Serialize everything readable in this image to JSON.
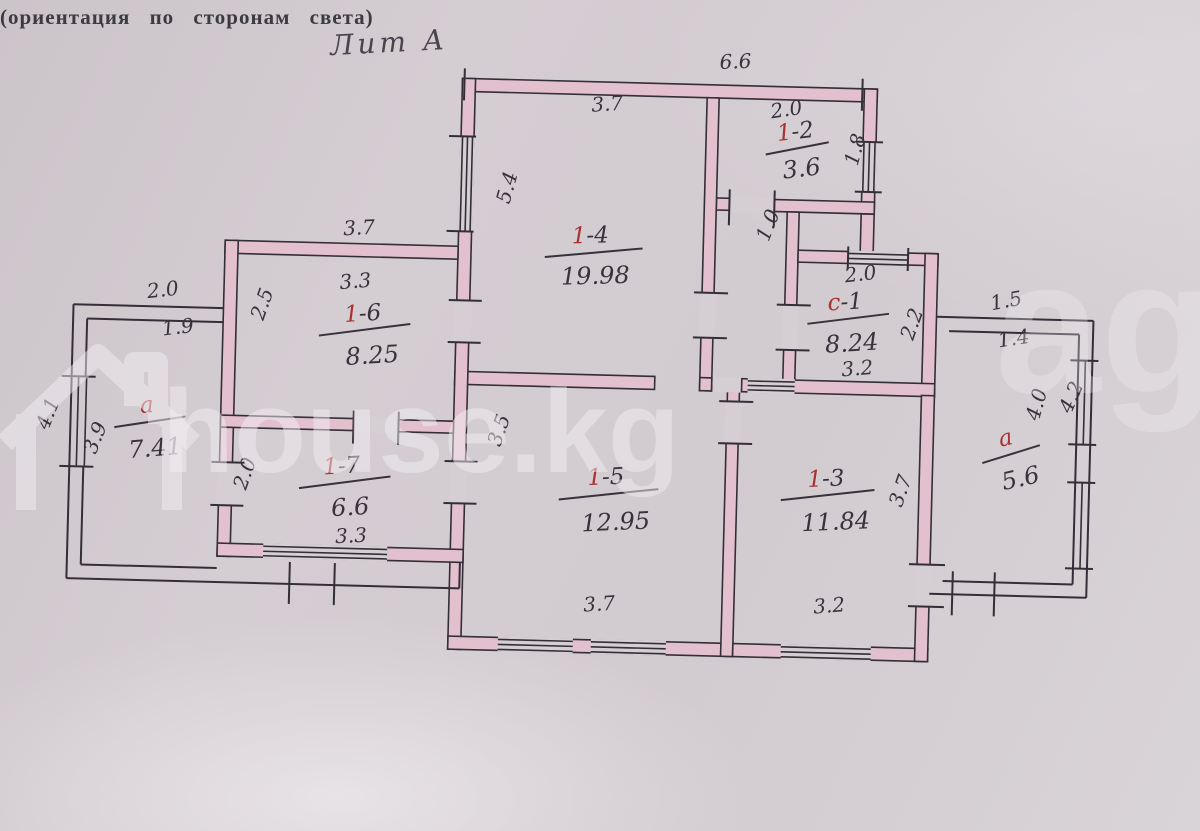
{
  "header": {
    "orientation_note": "(ориентация по сторонам света)",
    "liter_label": "Лит А"
  },
  "watermark": {
    "brand": "house.kg",
    "partial": "agi",
    "icon": "house-icon"
  },
  "rooms": [
    {
      "id_red": "1",
      "id_rest": "-4",
      "area": "19.98"
    },
    {
      "id_red": "1",
      "id_rest": "-2",
      "area": "3.6"
    },
    {
      "id_red": "с",
      "id_rest": "-1",
      "area": "8.24"
    },
    {
      "id_red": "1",
      "id_rest": "-6",
      "area": "8.25"
    },
    {
      "id_red": "а",
      "id_rest": "",
      "area": "7.41"
    },
    {
      "id_red": "1",
      "id_rest": "-7",
      "area": "6.6"
    },
    {
      "id_red": "1",
      "id_rest": "-5",
      "area": "12.95"
    },
    {
      "id_red": "1",
      "id_rest": "-3",
      "area": "11.84"
    },
    {
      "id_red": "а",
      "id_rest": "",
      "area": "5.6"
    }
  ],
  "dims": {
    "top_width": "6.6",
    "r14_top": "3.7",
    "r14_left": "5.4",
    "r12_top": "2.0",
    "r12_right": "1.8",
    "hall_width": "1.0",
    "c1_top": "2.0",
    "c1_right": "2.2",
    "c1_bottom": "3.2",
    "r16_outer_top": "3.7",
    "r16_top": "3.3",
    "r16_left": "2.5",
    "a_left_outer_top": "2.0",
    "a_left_top": "1.9",
    "a_left_outer_side": "4.1",
    "a_left_side": "3.9",
    "r17_left": "2.0",
    "r17_bottom": "3.3",
    "r15_left": "3.5",
    "r15_bottom": "3.7",
    "r13_right": "3.7",
    "r13_bottom": "3.2",
    "a_right_outer_top": "1.5",
    "a_right_top": "1.4",
    "a_right_side": "4.0",
    "a_right_outer_side": "4.2"
  }
}
